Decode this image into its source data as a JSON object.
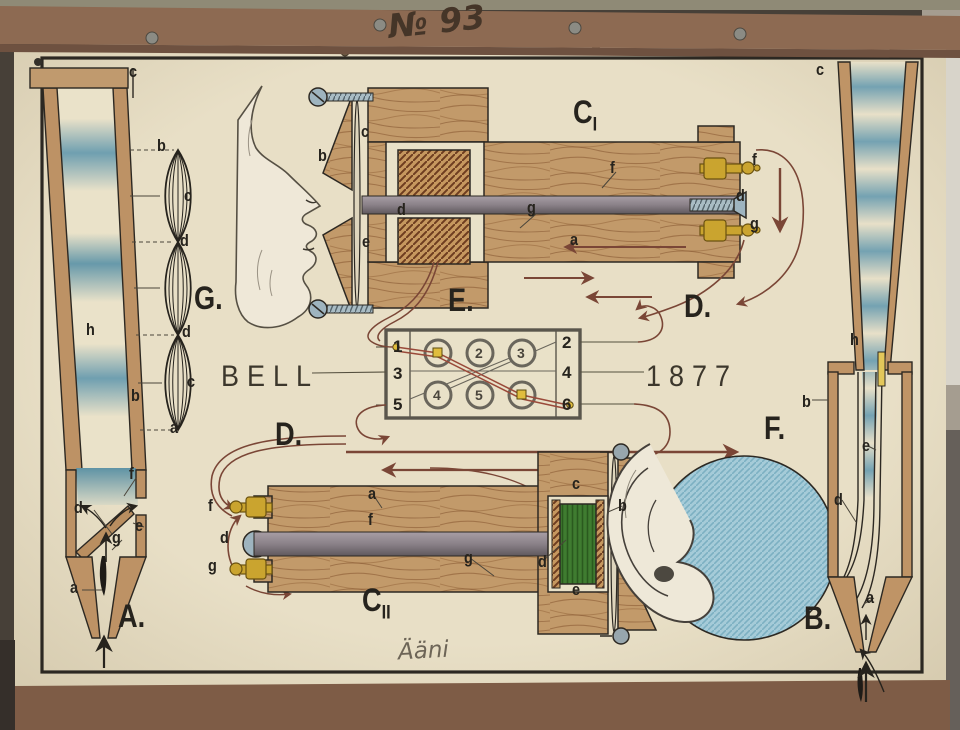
{
  "frame": {
    "number": "№ 93",
    "signature": "Ääni"
  },
  "texts": {
    "inventor": "BELL",
    "year": "1877"
  },
  "palette": {
    "poster_cream": "#e8dfc6",
    "wood_tan": "#c29a6a",
    "wave_blue": "#6fa0b0",
    "wire_brown": "#7a4636",
    "coil_green": "#3f7c30",
    "brass": "#c9a42f",
    "label_ink": "#26231d",
    "cardboard": "#8d6a52"
  },
  "annotations": [
    {
      "name": "label-pipe-a-c",
      "text": "c",
      "x": 129,
      "y": 62,
      "cls": "lbl"
    },
    {
      "name": "label-wave-b-top",
      "text": "b",
      "x": 157,
      "y": 136,
      "cls": "lbl"
    },
    {
      "name": "label-wave-c-upper",
      "text": "c",
      "x": 184,
      "y": 186,
      "cls": "lbl"
    },
    {
      "name": "label-wave-d-upper",
      "text": "d",
      "x": 180,
      "y": 231,
      "cls": "lbl"
    },
    {
      "name": "label-section-g",
      "text": "G.",
      "x": 194,
      "y": 280,
      "cls": "lbl big"
    },
    {
      "name": "label-pipe-a-h",
      "text": "h",
      "x": 86,
      "y": 320,
      "cls": "lbl"
    },
    {
      "name": "label-wave-d-lower",
      "text": "d",
      "x": 182,
      "y": 322,
      "cls": "lbl"
    },
    {
      "name": "label-wave-c-lower",
      "text": "c",
      "x": 187,
      "y": 372,
      "cls": "lbl"
    },
    {
      "name": "label-wave-b-bottom",
      "text": "b",
      "x": 131,
      "y": 386,
      "cls": "lbl"
    },
    {
      "name": "label-wave-a",
      "text": "a",
      "x": 170,
      "y": 418,
      "cls": "lbl"
    },
    {
      "name": "label-pipe-a-f",
      "text": "f",
      "x": 129,
      "y": 464,
      "cls": "lbl"
    },
    {
      "name": "label-pipe-a-d",
      "text": "d",
      "x": 74,
      "y": 498,
      "cls": "lbl"
    },
    {
      "name": "label-pipe-a-e",
      "text": "e",
      "x": 135,
      "y": 516,
      "cls": "lbl"
    },
    {
      "name": "label-pipe-a-g",
      "text": "g",
      "x": 112,
      "y": 528,
      "cls": "lbl"
    },
    {
      "name": "label-pipe-a-a",
      "text": "a",
      "x": 70,
      "y": 578,
      "cls": "lbl"
    },
    {
      "name": "label-section-a",
      "text": "A.",
      "x": 118,
      "y": 598,
      "cls": "lbl big"
    },
    {
      "name": "label-tx-b",
      "text": "b",
      "x": 318,
      "y": 146,
      "cls": "lbl"
    },
    {
      "name": "label-tx-c",
      "text": "c",
      "x": 361,
      "y": 122,
      "cls": "lbl"
    },
    {
      "name": "label-tx-d",
      "text": "d",
      "x": 397,
      "y": 200,
      "cls": "lbl"
    },
    {
      "name": "label-tx-e",
      "text": "e",
      "x": 362,
      "y": 232,
      "cls": "lbl"
    },
    {
      "name": "label-section-c1",
      "text": "C",
      "sub": "I",
      "x": 573,
      "y": 94,
      "cls": "lbl big"
    },
    {
      "name": "label-c1-f-wood",
      "text": "f",
      "x": 610,
      "y": 158,
      "cls": "lbl"
    },
    {
      "name": "label-c1-g-wood",
      "text": "g",
      "x": 527,
      "y": 198,
      "cls": "lbl"
    },
    {
      "name": "label-c1-a",
      "text": "a",
      "x": 570,
      "y": 230,
      "cls": "lbl"
    },
    {
      "name": "label-c1-f-terminal",
      "text": "f",
      "x": 752,
      "y": 150,
      "cls": "lbl"
    },
    {
      "name": "label-c1-d-screw",
      "text": "d",
      "x": 736,
      "y": 186,
      "cls": "lbl"
    },
    {
      "name": "label-c1-g-terminal",
      "text": "g",
      "x": 750,
      "y": 214,
      "cls": "lbl"
    },
    {
      "name": "label-section-d-right",
      "text": "D.",
      "x": 684,
      "y": 288,
      "cls": "lbl big"
    },
    {
      "name": "label-section-e",
      "text": "E.",
      "x": 448,
      "y": 282,
      "cls": "lbl big"
    },
    {
      "name": "terminal-1",
      "text": "1",
      "x": 393,
      "y": 337,
      "cls": "term"
    },
    {
      "name": "terminal-3",
      "text": "3",
      "x": 393,
      "y": 364,
      "cls": "term"
    },
    {
      "name": "terminal-5",
      "text": "5",
      "x": 393,
      "y": 395,
      "cls": "term"
    },
    {
      "name": "terminal-2",
      "text": "2",
      "x": 562,
      "y": 333,
      "cls": "term"
    },
    {
      "name": "terminal-4",
      "text": "4",
      "x": 562,
      "y": 363,
      "cls": "term"
    },
    {
      "name": "terminal-6",
      "text": "6",
      "x": 562,
      "y": 395,
      "cls": "term"
    },
    {
      "name": "jack-2",
      "text": "2",
      "x": 475,
      "y": 345,
      "cls": "circ"
    },
    {
      "name": "jack-3",
      "text": "3",
      "x": 517,
      "y": 345,
      "cls": "circ"
    },
    {
      "name": "jack-4",
      "text": "4",
      "x": 433,
      "y": 387,
      "cls": "circ"
    },
    {
      "name": "jack-5",
      "text": "5",
      "x": 475,
      "y": 387,
      "cls": "circ"
    },
    {
      "name": "label-section-d-left",
      "text": "D.",
      "x": 275,
      "y": 416,
      "cls": "lbl big"
    },
    {
      "name": "label-c2-f-terminal",
      "text": "f",
      "x": 208,
      "y": 496,
      "cls": "lbl"
    },
    {
      "name": "label-c2-d-cap",
      "text": "d",
      "x": 220,
      "y": 528,
      "cls": "lbl"
    },
    {
      "name": "label-c2-g-terminal",
      "text": "g",
      "x": 208,
      "y": 556,
      "cls": "lbl"
    },
    {
      "name": "label-c2-a",
      "text": "a",
      "x": 368,
      "y": 484,
      "cls": "lbl"
    },
    {
      "name": "label-c2-f-wood",
      "text": "f",
      "x": 368,
      "y": 510,
      "cls": "lbl"
    },
    {
      "name": "label-section-c2",
      "text": "C",
      "sub": "II",
      "x": 362,
      "y": 582,
      "cls": "lbl big"
    },
    {
      "name": "label-c2-g-wood",
      "text": "g",
      "x": 464,
      "y": 548,
      "cls": "lbl"
    },
    {
      "name": "label-c2-d-core",
      "text": "d",
      "x": 538,
      "y": 552,
      "cls": "lbl"
    },
    {
      "name": "label-rx-c",
      "text": "c",
      "x": 572,
      "y": 474,
      "cls": "lbl"
    },
    {
      "name": "label-rx-e",
      "text": "e",
      "x": 572,
      "y": 580,
      "cls": "lbl"
    },
    {
      "name": "label-rx-b",
      "text": "b",
      "x": 618,
      "y": 496,
      "cls": "lbl"
    },
    {
      "name": "label-section-f",
      "text": "F.",
      "x": 764,
      "y": 410,
      "cls": "lbl big"
    },
    {
      "name": "label-pipe-b-c",
      "text": "c",
      "x": 816,
      "y": 60,
      "cls": "lbl"
    },
    {
      "name": "label-pipe-b-h",
      "text": "h",
      "x": 850,
      "y": 330,
      "cls": "lbl"
    },
    {
      "name": "label-pipe-b-b",
      "text": "b",
      "x": 802,
      "y": 392,
      "cls": "lbl"
    },
    {
      "name": "label-pipe-b-e",
      "text": "e",
      "x": 862,
      "y": 436,
      "cls": "lbl"
    },
    {
      "name": "label-pipe-b-d",
      "text": "d",
      "x": 834,
      "y": 490,
      "cls": "lbl"
    },
    {
      "name": "label-pipe-b-a",
      "text": "a",
      "x": 866,
      "y": 588,
      "cls": "lbl"
    },
    {
      "name": "label-section-b",
      "text": "B.",
      "x": 804,
      "y": 600,
      "cls": "lbl big"
    }
  ]
}
